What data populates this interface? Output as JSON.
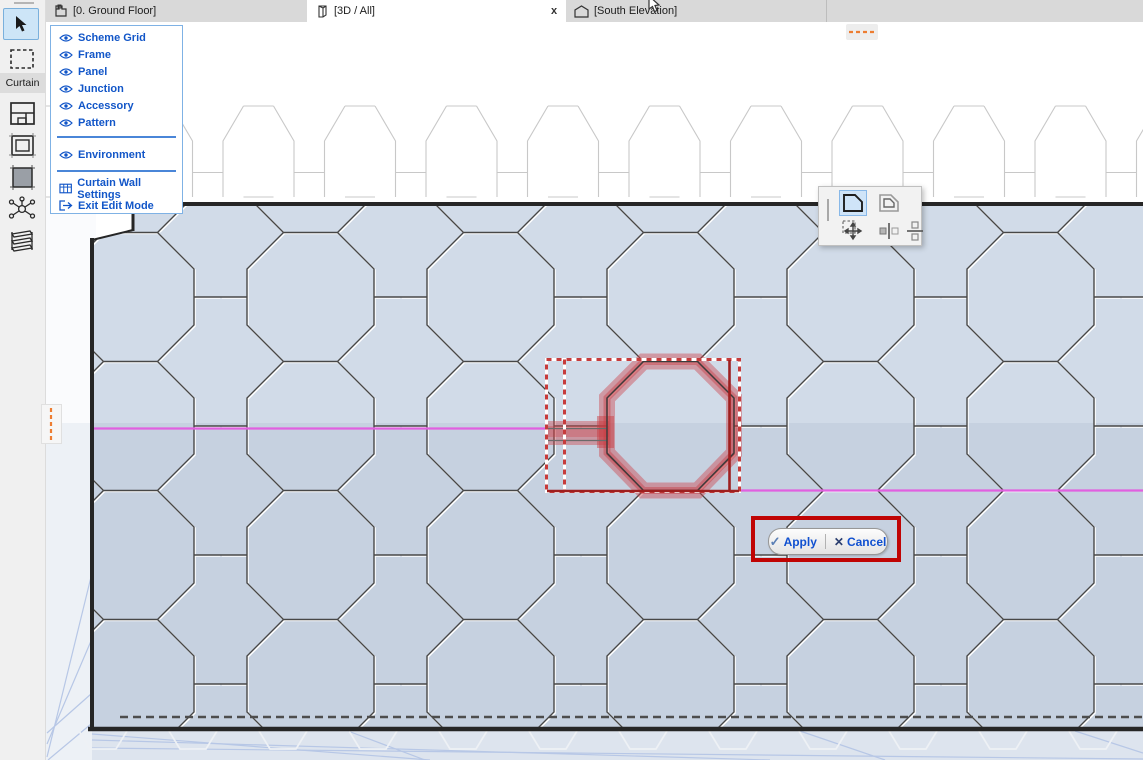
{
  "window": {
    "app": "ArchiCAD curtain wall edit mode",
    "view": "3D"
  },
  "tabs": [
    {
      "label": "[0. Ground Floor]",
      "icon": "floor-plan-icon",
      "active": false
    },
    {
      "label": "[3D / All]",
      "icon": "3d-box-icon",
      "active": true,
      "close_label": "x"
    },
    {
      "label": "[South Elevation]",
      "icon": "elevation-icon",
      "active": false
    }
  ],
  "toolbar": {
    "curtain_label": "Curtain",
    "tools": [
      "select-arrow",
      "marquee",
      "scheme-grid-tool",
      "frame-tool",
      "panel-tool",
      "junction-tool",
      "accessory-tool"
    ]
  },
  "context_menu": {
    "items": [
      {
        "label": "Scheme Grid",
        "icon": "eye-icon"
      },
      {
        "label": "Frame",
        "icon": "eye-icon"
      },
      {
        "label": "Panel",
        "icon": "eye-icon"
      },
      {
        "label": "Junction",
        "icon": "eye-icon"
      },
      {
        "label": "Accessory",
        "icon": "eye-icon"
      },
      {
        "label": "Pattern",
        "icon": "eye-icon"
      },
      {
        "label": "Environment",
        "icon": "eye-icon"
      },
      {
        "label": "Curtain Wall Settings",
        "icon": "settings-table-icon"
      },
      {
        "label": "Exit Edit Mode",
        "icon": "exit-icon"
      }
    ]
  },
  "pet_palette": {
    "icons": [
      "panel-shape-icon",
      "panel-offset-icon",
      "move-marquee-icon",
      "split-vertical-icon",
      "split-horizontal-icon"
    ],
    "selected_index": 0
  },
  "apply_cancel": {
    "apply_label": "Apply",
    "cancel_label": "Cancel"
  },
  "colors": {
    "magenta_gridline": "#e160e0",
    "selection_red": "rgba(205,62,68,0.45)",
    "selection_dark_red": "#9e1f1f",
    "annotation_red": "#c00404",
    "orange_dash": "#ed7d31",
    "wall_fill_upper": "#d1dbe8",
    "wall_fill_lower": "#c6d1e0",
    "accent_blue": "#1256c8"
  }
}
